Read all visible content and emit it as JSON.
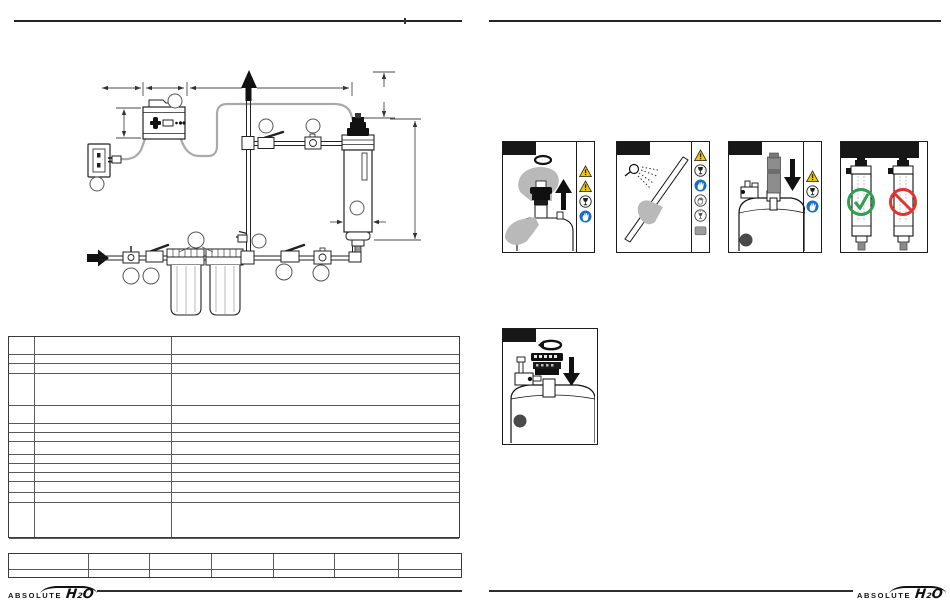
{
  "page": {
    "kind": "manual-spread",
    "background": "#ffffff"
  },
  "left_page": {
    "diagram": {
      "name": "uv-system-installation-diagram",
      "line_color": "#2a2a2a",
      "cable_color": "#a9a9a9",
      "flow_arrows": [
        "water-inlet-arrow",
        "outlet-up-arrow"
      ],
      "callout_circles": 11,
      "components": [
        "controller-box",
        "wall-outlet",
        "power-plug",
        "riser-pipe",
        "ball-valve",
        "check-valve",
        "filter-housing-1",
        "filter-housing-2",
        "sample-valve",
        "uv-chamber",
        "lamp-connector",
        "drain-fitting"
      ]
    },
    "parts_table": {
      "columns": 3,
      "rows": 14
    },
    "title_block": {
      "columns": 7,
      "rows": 2
    }
  },
  "right_page": {
    "panels": [
      {
        "id": "pull-lamp-plug",
        "step_header": "",
        "icons": [
          "warning-icon",
          "warning-icon",
          "fragile-glass-icon",
          "wear-gloves-icon"
        ]
      },
      {
        "id": "rinse-quartz-sleeve",
        "step_header": "",
        "icons": [
          "warning-icon",
          "fragile-glass-icon",
          "wear-gloves-icon",
          "no-bare-hands-icon",
          "broken-glass-icon",
          "soft-cloth-icon"
        ]
      },
      {
        "id": "insert-uv-lamp",
        "step_header": "",
        "icons": [
          "warning-icon",
          "fragile-glass-icon",
          "wear-gloves-icon"
        ]
      },
      {
        "id": "mounting-orientation",
        "step_header": "",
        "icons": [],
        "marks": [
          "correct-check",
          "incorrect-prohibited"
        ]
      },
      {
        "id": "refit-lamp-plug",
        "step_header": "",
        "icons": []
      }
    ],
    "status_colors": {
      "correct": "#2f9e4f",
      "incorrect": "#e23333",
      "warning": "#f6c500",
      "mandatory": "#1a6ebe"
    }
  },
  "footer": {
    "left_brand": {
      "text": "ABSOLUTE",
      "mark": "H₂O"
    },
    "right_brand": {
      "text": "ABSOLUTE",
      "mark": "H₂O"
    }
  }
}
